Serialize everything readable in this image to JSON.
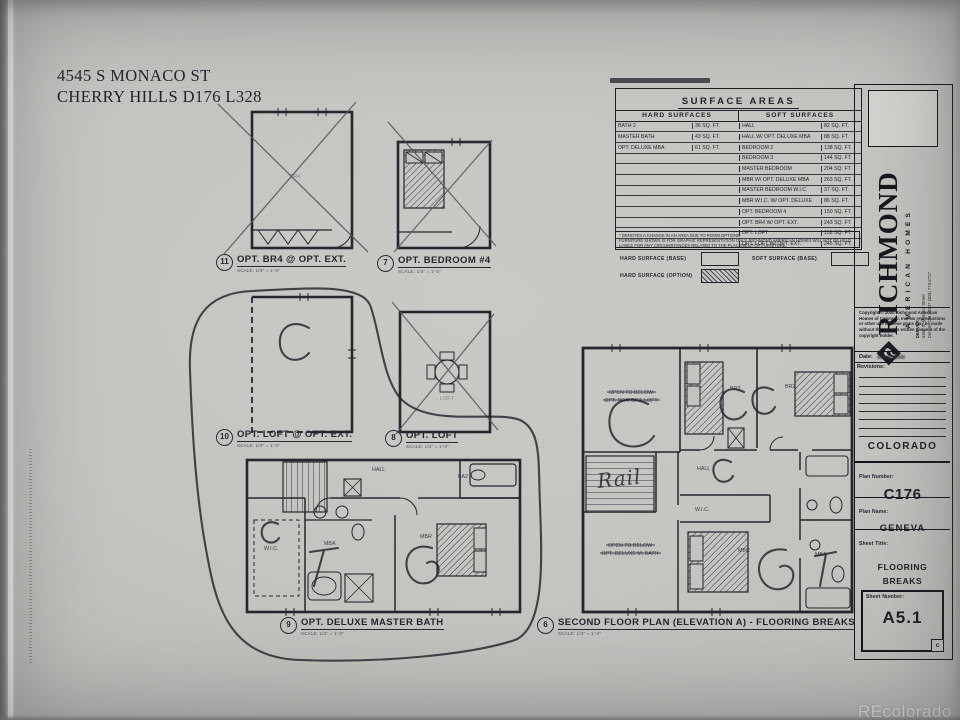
{
  "page": {
    "address_line1": "4545 S MONACO ST",
    "address_line2": "CHERRY HILLS  D176  L328",
    "watermark": "REcolorado"
  },
  "surface_table": {
    "title": "SURFACE AREAS",
    "hard_header": "HARD SURFACES",
    "soft_header": "SOFT SURFACES",
    "rows": [
      {
        "hl": "BATH 2",
        "hv": "36 SQ. FT.",
        "sl": "HALL",
        "sv": "82 SQ. FT."
      },
      {
        "hl": "MASTER BATH",
        "hv": "43 SQ. FT.",
        "sl": "HALL W/ OPT. DELUXE MBA",
        "sv": "88 SQ. FT."
      },
      {
        "hl": "OPT. DELUXE MBA",
        "hv": "61 SQ. FT.",
        "sl": "BEDROOM 2",
        "sv": "138 SQ. FT."
      },
      {
        "hl": "",
        "hv": "",
        "sl": "BEDROOM 3",
        "sv": "144 SQ. FT."
      },
      {
        "hl": "",
        "hv": "",
        "sl": "MASTER BEDROOM",
        "sv": "204 SQ. FT."
      },
      {
        "hl": "",
        "hv": "",
        "sl": "MBR W/ OPT. DELUXE MBA",
        "sv": "263 SQ. FT."
      },
      {
        "hl": "",
        "hv": "",
        "sl": "MASTER BEDROOM W.I.C.",
        "sv": "37 SQ. FT."
      },
      {
        "hl": "",
        "hv": "",
        "sl": "MBR W.I.C. W/ OPT. DELUXE",
        "sv": "86 SQ. FT."
      },
      {
        "hl": "",
        "hv": "",
        "sl": "OPT. BEDROOM 4",
        "sv": "150 SQ. FT."
      },
      {
        "hl": "",
        "hv": "",
        "sl": "OPT. BR4 W/ OPT. EXT.",
        "sv": "243 SQ. FT."
      },
      {
        "hl": "",
        "hv": "",
        "sl": "OPT. LOFT",
        "sv": "152 SQ. FT."
      },
      {
        "hl": "",
        "hv": "",
        "sl": "OPT. LOFT W/ OPT. EXT.",
        "sv": "245 SQ. FT."
      }
    ],
    "note1": "* DENOTES A CHANGE IN AN AREA DUE TO ROOM OPTIONS.",
    "note2": "FURNITURE SHOWN IS FOR GRAPHIC REPRESENTATION ONLY. RICHMOND AMERICAN HOMES WILL NOT BE HELD LIABLE FOR ANY CIRCUMSTANCES RELATED TO THE PLACEMENT OF FURNITURE."
  },
  "legend": {
    "hard_base": "HARD SURFACE (BASE)",
    "soft_base": "SOFT SURFACE (BASE)",
    "hard_option": "HARD SURFACE (OPTION)"
  },
  "plans": {
    "p11": {
      "num": "11",
      "title": "OPT. BR4 @ OPT. EXT.",
      "scale": "SCALE:  1/4\" = 1'-0\""
    },
    "p7": {
      "num": "7",
      "title": "OPT. BEDROOM #4",
      "scale": "SCALE:  1/4\" = 1'-0\""
    },
    "p10": {
      "num": "10",
      "title": "OPT. LOFT @ OPT. EXT.",
      "scale": "SCALE:  1/4\" = 1'-0\""
    },
    "p8": {
      "num": "8",
      "title": "OPT. LOFT",
      "scale": "SCALE:  1/4\" = 1'-0\""
    },
    "p9": {
      "num": "9",
      "title": "OPT. DELUXE MASTER BATH",
      "scale": "SCALE:  1/4\" = 1'-0\""
    },
    "p6": {
      "num": "6",
      "title": "SECOND FLOOR PLAN (ELEVATION A) - FLOORING BREAKS",
      "scale": "SCALE:  1/4\" = 1'-0\""
    }
  },
  "rooms": {
    "hall": "HALL",
    "wic": "W.I.C.",
    "mbr": "MBR",
    "mba": "MBA",
    "ba2": "BA2",
    "br2": "BR2",
    "br3": "BR3",
    "br4": "BR4",
    "loft": "LOFT",
    "open_below": "OPEN TO BELOW",
    "opt_br4_loft": "OPT. BR4/ OPT. LOFT",
    "opt_deluxe_mbath": "OPT. DELUXE M. BATH",
    "rail": "Rail"
  },
  "titleblock": {
    "brand": "RICHMOND",
    "brand_sub": "AMERICAN HOMES",
    "office": "DENVER",
    "addr1": "4350 S. Monaco Street",
    "addr2": "Denver, CO 80237  (303) 773-2727",
    "copyright": "Copyright © 2000 Richmond American Homes of Colorado, Inc. No reproductions or other use of these plans may be made without the express written consent of the copyright holder.",
    "date_label": "Date:",
    "revisions_label": "Revisions:",
    "state": "COLORADO",
    "plan_number_label": "Plan Number:",
    "plan_number": "C176",
    "plan_name_label": "Plan Name:",
    "plan_name": "GENEVA",
    "sheet_title_label": "Sheet Title:",
    "sheet_title_line1": "FLOORING",
    "sheet_title_line2": "BREAKS",
    "sheet_number_label": "Sheet Number:",
    "sheet_number": "A5.1",
    "rev_letter": "c"
  }
}
